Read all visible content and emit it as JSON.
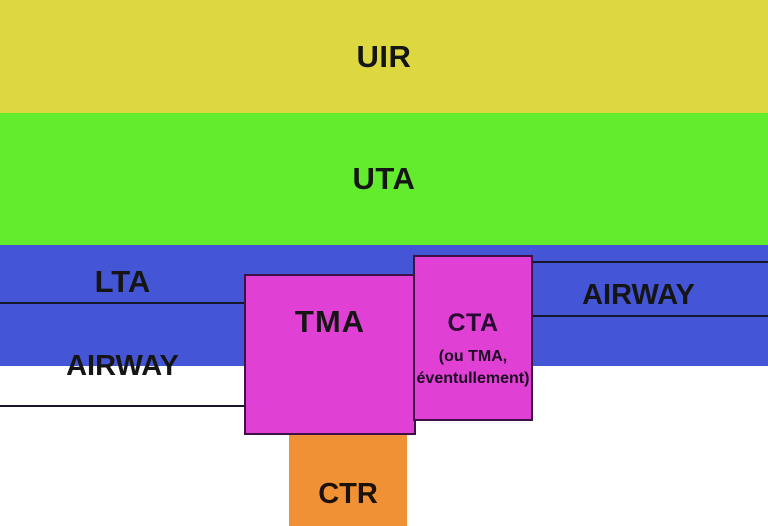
{
  "colors": {
    "uir_yellow": "#ddd83f",
    "uta_green": "#63ec2d",
    "airspace_blue": "#4456d6",
    "tma_cta_magenta": "#e041d4",
    "ctr_orange": "#ef9134",
    "box_border_dark": "#3d1145",
    "level_line_dark": "#17172c",
    "label_text": "#151515",
    "background_white": "#ffffff"
  },
  "zones": {
    "uir": {
      "label": "UIR"
    },
    "uta": {
      "label": "UTA"
    },
    "lta": {
      "label": "LTA"
    },
    "airway_left": {
      "label": "AIRWAY"
    },
    "airway_right": {
      "label": "AIRWAY"
    },
    "tma": {
      "label": "TMA"
    },
    "cta": {
      "label": "CTA",
      "note_line1": "(ou TMA,",
      "note_line2": "éventullement)"
    },
    "ctr": {
      "label": "CTR"
    }
  }
}
